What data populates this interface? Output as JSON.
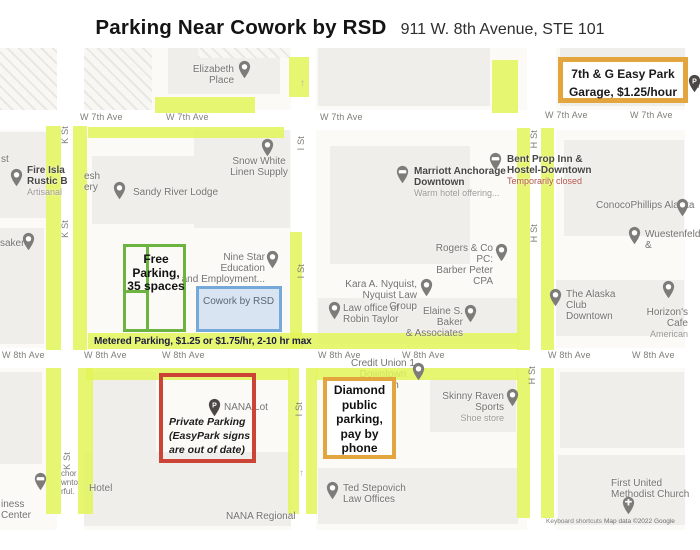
{
  "header": {
    "title": "Parking Near Cowork by RSD",
    "address": "911 W. 8th Avenue, STE 101"
  },
  "annotations": {
    "easy_park": "7th & G Easy Park\nGarage, $1.25/hour",
    "free_parking": "Free\nParking,\n35 spaces",
    "metered": "Metered Parking, $1.25 or $1.75/hr, 2-10 hr max",
    "cowork": "Cowork by RSD",
    "private_parking": "Private Parking\n(EasyPark signs\nare out of date)",
    "diamond": "Diamond\npublic\nparking,\npay by\nphone"
  },
  "colors": {
    "highlight": "rgba(227,245,88,0.85)",
    "green": "#6db33f",
    "red": "#cc4435",
    "orange": "#e3a53e",
    "blue_border": "#74a9da",
    "blue_fill": "rgba(173,201,232,0.45)",
    "metered_text": "#1c1c40"
  },
  "streets": {
    "w7th": "W 7th Ave",
    "w8th": "W 8th Ave",
    "k": "K St",
    "i": "I St",
    "h": "H St"
  },
  "street_labels": [
    {
      "s": "w7th",
      "x": 80,
      "y": 112
    },
    {
      "s": "w7th",
      "x": 166,
      "y": 112
    },
    {
      "s": "w7th",
      "x": 320,
      "y": 112
    },
    {
      "s": "w7th",
      "x": 545,
      "y": 110
    },
    {
      "s": "w7th",
      "x": 630,
      "y": 110
    },
    {
      "s": "w8th",
      "x": 2,
      "y": 350
    },
    {
      "s": "w8th",
      "x": 84,
      "y": 350
    },
    {
      "s": "w8th",
      "x": 162,
      "y": 350
    },
    {
      "s": "w8th",
      "x": 318,
      "y": 350
    },
    {
      "s": "w8th",
      "x": 402,
      "y": 350
    },
    {
      "s": "w8th",
      "x": 548,
      "y": 350
    },
    {
      "s": "w8th",
      "x": 632,
      "y": 350
    },
    {
      "s": "k",
      "x": 60,
      "y": 126,
      "v": true
    },
    {
      "s": "k",
      "x": 60,
      "y": 220,
      "v": true
    },
    {
      "s": "k",
      "x": 62,
      "y": 452,
      "v": true
    },
    {
      "s": "i",
      "x": 296,
      "y": 136,
      "v": true
    },
    {
      "s": "i",
      "x": 296,
      "y": 264,
      "v": true
    },
    {
      "s": "i",
      "x": 294,
      "y": 402,
      "v": true
    },
    {
      "s": "h",
      "x": 529,
      "y": 130,
      "v": true
    },
    {
      "s": "h",
      "x": 529,
      "y": 224,
      "v": true
    },
    {
      "s": "h",
      "x": 527,
      "y": 366,
      "v": true
    }
  ],
  "places": [
    {
      "id": "elizabeth-place",
      "name": "Elizabeth Place",
      "x": 166,
      "y": 64,
      "w": 68,
      "align": "right",
      "pin": {
        "x": 238,
        "y": 60,
        "t": "generic"
      }
    },
    {
      "id": "snow-white-linen",
      "name": "Snow White\nLinen Supply",
      "x": 221,
      "y": 156,
      "w": 76,
      "align": "center",
      "pin": {
        "x": 261,
        "y": 138,
        "t": "generic"
      }
    },
    {
      "id": "sandy-river-lodge",
      "name": "Sandy River Lodge",
      "x": 133,
      "y": 187,
      "w": 110,
      "align": "left",
      "pin": {
        "x": 113,
        "y": 181,
        "t": "generic"
      }
    },
    {
      "id": "fire-island",
      "name": "Fire Isla\nRustic B",
      "bold": true,
      "sub": "Artisanal",
      "x": 27,
      "y": 165,
      "w": 46,
      "align": "left",
      "pin": {
        "x": 10,
        "y": 168,
        "t": "food"
      }
    },
    {
      "id": "fire-island-frag",
      "name": "esh\nery",
      "x": 84,
      "y": 171,
      "w": 20,
      "align": "left"
    },
    {
      "id": "st-frag",
      "name": "st",
      "x": 1,
      "y": 154,
      "w": 14,
      "align": "left"
    },
    {
      "id": "saker",
      "name": "saker",
      "x": 0,
      "y": 238,
      "w": 30,
      "align": "left",
      "pin": {
        "x": 22,
        "y": 232,
        "t": "generic"
      }
    },
    {
      "id": "nine-star",
      "name": "Nine Star Education\nand Employment...",
      "x": 181,
      "y": 252,
      "w": 84,
      "align": "right",
      "pin": {
        "x": 266,
        "y": 250,
        "t": "education"
      }
    },
    {
      "id": "marriott",
      "name": "Marriott Anchorage\nDowntown",
      "bold": true,
      "sub": "Warm hotel offering...",
      "x": 414,
      "y": 166,
      "w": 92,
      "align": "left",
      "pin": {
        "x": 396,
        "y": 165,
        "t": "lodging"
      }
    },
    {
      "id": "bent-prop",
      "name": "Bent Prop Inn &\nHostel-Downtown",
      "bold": true,
      "sub": "Temporarily closed",
      "subColor": "#b3554d",
      "x": 507,
      "y": 154,
      "w": 88,
      "align": "left",
      "pin": {
        "x": 489,
        "y": 152,
        "t": "lodging"
      }
    },
    {
      "id": "conocophillips",
      "name": "ConocoPhillips Alaska",
      "x": 596,
      "y": 200,
      "w": 110,
      "align": "left",
      "pin": {
        "x": 676,
        "y": 198,
        "t": "generic"
      }
    },
    {
      "id": "wuestenfeld",
      "name": "Wuestenfeld &",
      "x": 645,
      "y": 229,
      "w": 60,
      "align": "left",
      "pin": {
        "x": 628,
        "y": 226,
        "t": "generic"
      }
    },
    {
      "id": "rogers",
      "name": "Rogers & Co PC:\nBarber Peter CPA",
      "x": 421,
      "y": 243,
      "w": 72,
      "align": "right",
      "pin": {
        "x": 495,
        "y": 243,
        "t": "generic"
      }
    },
    {
      "id": "kara-nyquist",
      "name": "Kara A. Nyquist,\nNyquist Law Group",
      "x": 345,
      "y": 279,
      "w": 72,
      "align": "right",
      "pin": {
        "x": 420,
        "y": 278,
        "t": "generic"
      }
    },
    {
      "id": "robin-taylor",
      "name": "Law office of\nRobin Taylor",
      "x": 343,
      "y": 303,
      "w": 64,
      "align": "left",
      "pin": {
        "x": 328,
        "y": 301,
        "t": "generic"
      }
    },
    {
      "id": "elaine-baker",
      "name": "Elaine S. Baker\n& Associates",
      "x": 399,
      "y": 306,
      "w": 64,
      "align": "right",
      "pin": {
        "x": 464,
        "y": 304,
        "t": "work"
      }
    },
    {
      "id": "alaska-club",
      "name": "The Alaska\nClub Downtown",
      "x": 566,
      "y": 289,
      "w": 70,
      "align": "left",
      "pin": {
        "x": 549,
        "y": 288,
        "t": "generic"
      }
    },
    {
      "id": "horizons-cafe",
      "name": "Horizon's Cafe",
      "sub": "American",
      "x": 624,
      "y": 307,
      "w": 64,
      "align": "right",
      "pin": {
        "x": 662,
        "y": 280,
        "t": "food"
      }
    },
    {
      "id": "credit-union",
      "name": "Credit Union 1\nDowntown Branch",
      "x": 348,
      "y": 358,
      "w": 70,
      "align": "center",
      "under": true,
      "pin": {
        "x": 412,
        "y": 362,
        "t": "bank"
      }
    },
    {
      "id": "nana-lot",
      "name": "NANA Lot",
      "x": 224,
      "y": 402,
      "w": 50,
      "align": "left",
      "pin": {
        "x": 208,
        "y": 398,
        "t": "p"
      }
    },
    {
      "id": "skinny-raven",
      "name": "Skinny Raven Sports",
      "sub": "Shoe store",
      "x": 424,
      "y": 391,
      "w": 80,
      "align": "right",
      "pin": {
        "x": 506,
        "y": 388,
        "t": "shopping"
      }
    },
    {
      "id": "ted-stepovich",
      "name": "Ted Stepovich\nLaw Offices",
      "x": 343,
      "y": 483,
      "w": 70,
      "align": "left",
      "pin": {
        "x": 326,
        "y": 481,
        "t": "generic"
      }
    },
    {
      "id": "first-united",
      "name": "First United\nMethodist Church",
      "x": 611,
      "y": 478,
      "w": 86,
      "align": "left",
      "pin": {
        "x": 622,
        "y": 496,
        "t": "church"
      }
    },
    {
      "id": "hotel",
      "name": "Hotel",
      "x": 89,
      "y": 483,
      "w": 34,
      "align": "left"
    },
    {
      "id": "nana-regional",
      "name": "NANA Regional",
      "x": 226,
      "y": 511,
      "w": 80,
      "align": "left"
    },
    {
      "id": "business-center",
      "name": "iness\nCenter",
      "x": 1,
      "y": 499,
      "w": 34,
      "align": "left"
    },
    {
      "id": "hotel-frag",
      "name": "chor\nwnto\nrful.",
      "small": true,
      "x": 61,
      "y": 469,
      "w": 22,
      "align": "left",
      "pin": {
        "x": 34,
        "y": 472,
        "t": "lodging"
      }
    },
    {
      "id": "seventh-g-frag",
      "name": "7t",
      "x": 696,
      "y": 80,
      "w": 10,
      "align": "left",
      "pin": {
        "x": 688,
        "y": 74,
        "t": "p"
      }
    }
  ],
  "arrows": [
    [
      300,
      78
    ],
    [
      300,
      338
    ],
    [
      299,
      468
    ]
  ],
  "map_shapes": {
    "roads_h": [
      [
        0,
        110,
        700,
        20
      ],
      [
        0,
        348,
        700,
        20
      ]
    ],
    "roads_v": [
      [
        57,
        48,
        27,
        482
      ],
      [
        291,
        48,
        25,
        482
      ],
      [
        527,
        48,
        29,
        482
      ],
      [
        685,
        48,
        15,
        482
      ]
    ],
    "strips": [
      [
        155,
        97,
        100,
        16
      ],
      [
        289,
        57,
        20,
        40
      ],
      [
        88,
        127,
        196,
        11
      ],
      [
        46,
        126,
        15,
        224
      ],
      [
        73,
        126,
        14,
        224
      ],
      [
        46,
        368,
        15,
        146
      ],
      [
        78,
        368,
        15,
        146
      ],
      [
        290,
        232,
        12,
        116
      ],
      [
        288,
        368,
        11,
        146
      ],
      [
        306,
        368,
        11,
        146
      ],
      [
        492,
        60,
        26,
        53
      ],
      [
        517,
        128,
        13,
        222
      ],
      [
        541,
        128,
        13,
        222
      ],
      [
        517,
        368,
        13,
        150
      ],
      [
        541,
        368,
        13,
        150
      ],
      [
        88,
        333,
        430,
        16
      ],
      [
        86,
        368,
        204,
        12
      ],
      [
        316,
        368,
        202,
        12
      ]
    ],
    "buildings": [
      [
        168,
        48,
        112,
        46
      ],
      [
        318,
        48,
        172,
        58
      ],
      [
        560,
        48,
        128,
        58
      ],
      [
        0,
        132,
        46,
        86
      ],
      [
        92,
        156,
        156,
        68
      ],
      [
        194,
        130,
        96,
        98
      ],
      [
        330,
        146,
        140,
        118
      ],
      [
        564,
        140,
        120,
        96
      ],
      [
        318,
        298,
        202,
        46
      ],
      [
        548,
        280,
        136,
        56
      ],
      [
        0,
        228,
        44,
        116
      ],
      [
        92,
        372,
        64,
        142
      ],
      [
        0,
        372,
        42,
        92
      ],
      [
        430,
        378,
        86,
        54
      ],
      [
        560,
        372,
        124,
        76
      ],
      [
        318,
        468,
        200,
        56
      ],
      [
        558,
        455,
        142,
        70
      ],
      [
        60,
        452,
        244,
        74
      ]
    ],
    "hatches": [
      [
        0,
        48,
        152,
        62
      ],
      [
        198,
        48,
        92,
        10
      ]
    ]
  },
  "attribution": {
    "shortcuts": "Keyboard shortcuts",
    "map_data": "Map data ©2022 Google"
  }
}
